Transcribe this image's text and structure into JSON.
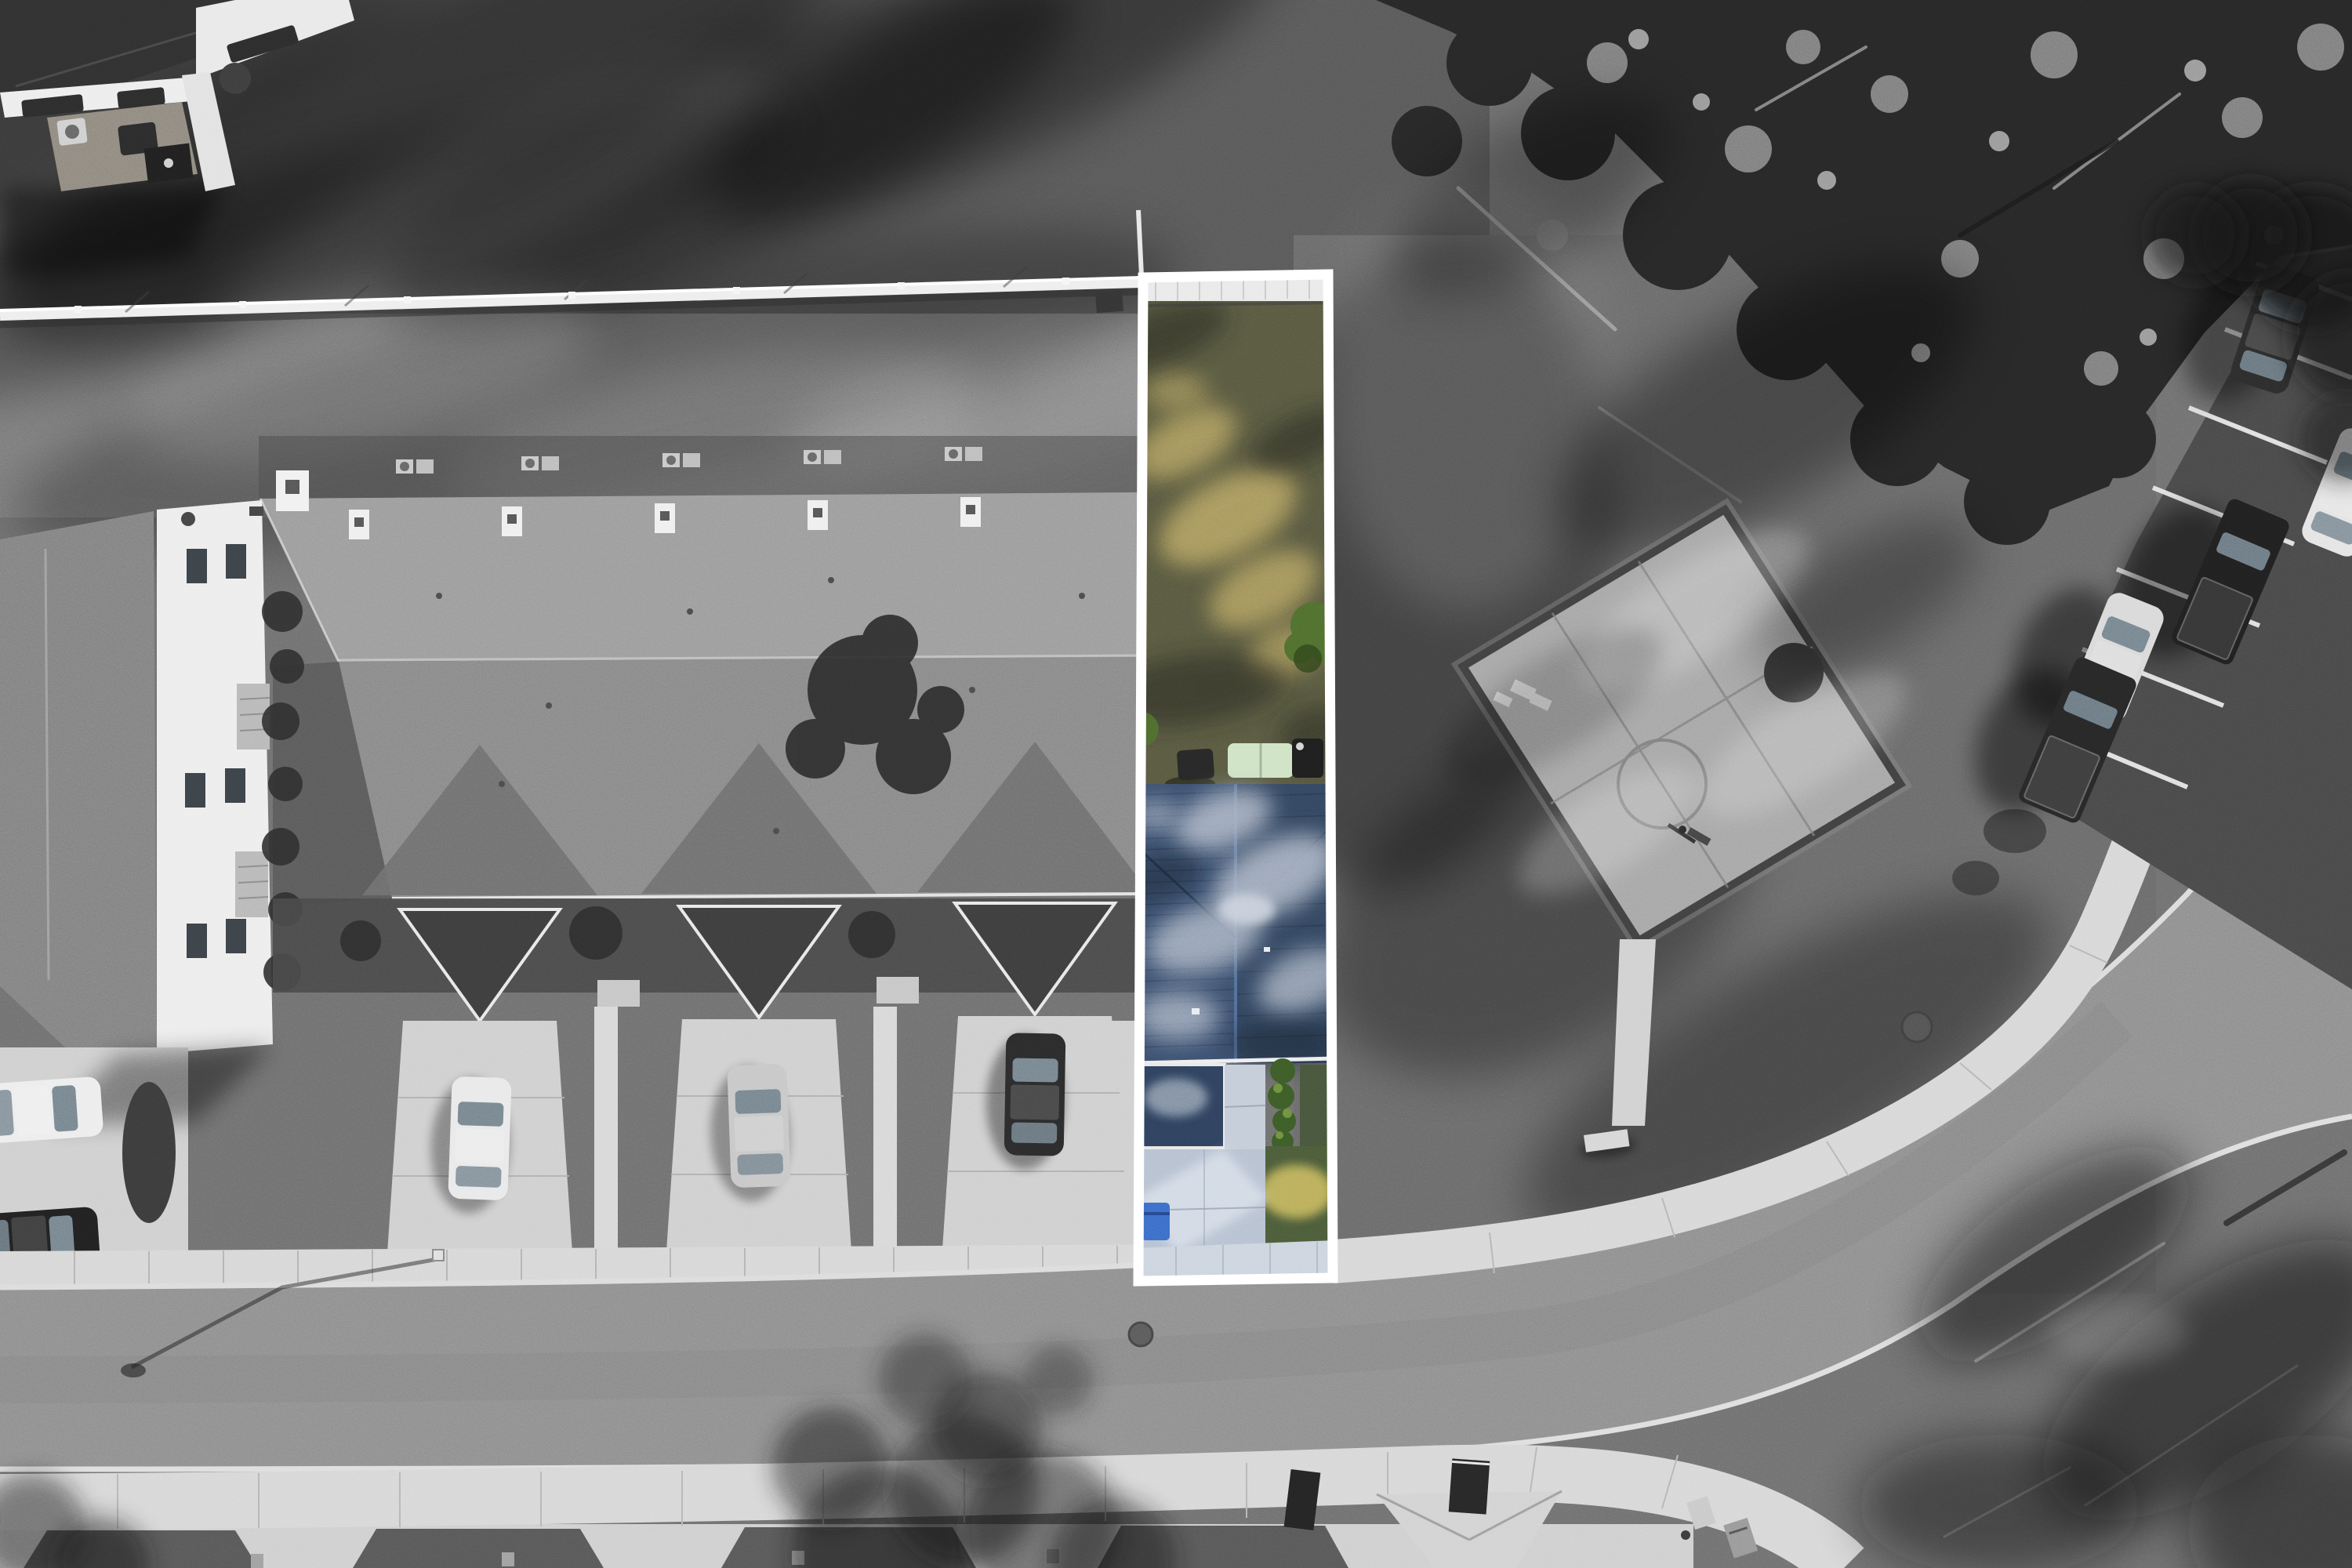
{
  "scene": {
    "kind": "aerial-drone-photo",
    "treatment": "grayscale-photo-with-selective-color-highlighted-property-lot",
    "regions": [
      "top-left-building-patio",
      "back-lawn",
      "privacy-fence",
      "townhouse-row-roof",
      "white-end-facade",
      "driveways-with-cars",
      "highlighted-lot",
      "lot-backyard-grass",
      "lot-blue-roof",
      "lot-driveway",
      "basketball-court",
      "woods",
      "curving-street",
      "bottom-sidewalk",
      "right-parking-lot",
      "parked-vehicles",
      "grass-field"
    ]
  },
  "colors": {
    "background_gray": "#6f6f6f",
    "lawn_dark": "#585858",
    "lawn_mid": "#7c7c7c",
    "woods_dark": "#262626",
    "fence_white": "#eeeeee",
    "roof_back_gray": "#9c9c9c",
    "roof_front_gray": "#898989",
    "gable_dark": "#3c3c3c",
    "facade_white": "#ededed",
    "driveway_concrete": "#cfcfcf",
    "sidewalk_concrete": "#d7d7d7",
    "road_asphalt": "#8f8f8f",
    "curb_white": "#dcdcdc",
    "parking_asphalt": "#484848",
    "stall_line_white": "#dfdfdf",
    "court_concrete": "#a6a6a6",
    "court_border": "#3f3f3f",
    "highlight_border": "#ffffff",
    "lot_back_grass": "#57583f",
    "lot_grass_sunlit": "#b7a463",
    "lot_bush_green": "#4e6d2d",
    "lot_roof_blue": "#32455f",
    "lot_roof_dapple": "#a9b3c4",
    "lot_porch_roof": "#2d405c",
    "lot_driveway_blue": "#b6c1d1",
    "lot_front_lawn": "#4a5a38",
    "lot_lawn_sunlit": "#c0b35c",
    "lot_sidewalk": "#ccd4df",
    "recycle_bin_blue": "#3a6cc8",
    "hedge_green": "#3b5a26",
    "car_white": "#e9e9e9",
    "car_silver": "#c7c7c7",
    "car_dark": "#2a2a2a",
    "truck_black": "#1f1f1f"
  }
}
